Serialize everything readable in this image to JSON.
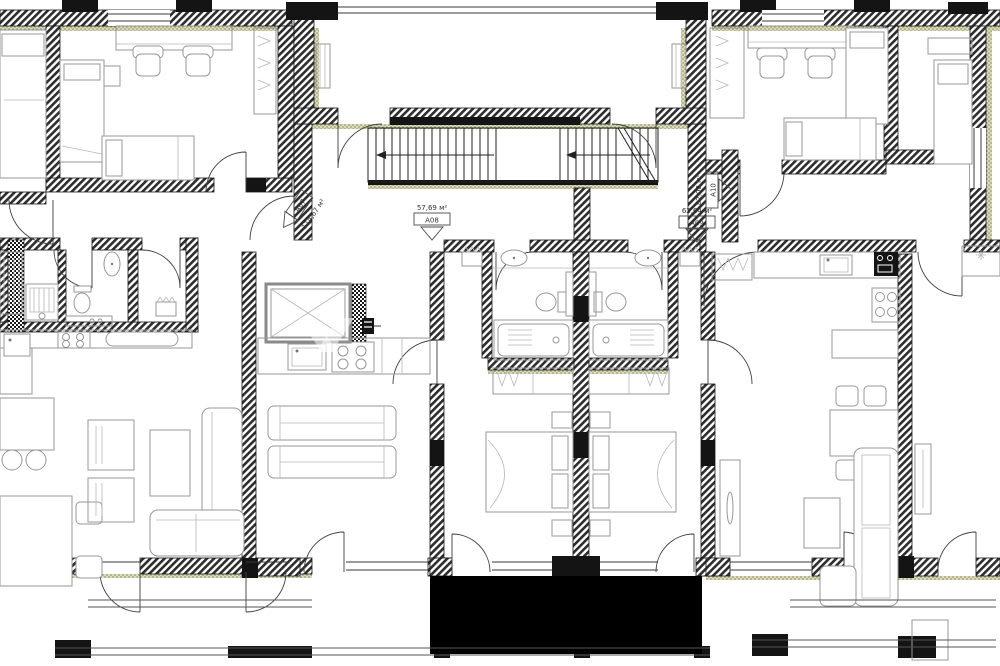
{
  "drawing": {
    "type": "apartment-floor-plan",
    "units": [
      {
        "id": "A07",
        "area": "114,67 м²"
      },
      {
        "id": "A08",
        "area": "57,69 м²"
      },
      {
        "id": "A09",
        "area": "62,64 м²"
      },
      {
        "id": "A10",
        "area": "82,08 м²"
      }
    ],
    "colors": {
      "wall": "#2d2d2d",
      "insulation": "#8f8f58",
      "furniture": "#979797",
      "background": "#ffffff",
      "label": "#333333"
    }
  }
}
